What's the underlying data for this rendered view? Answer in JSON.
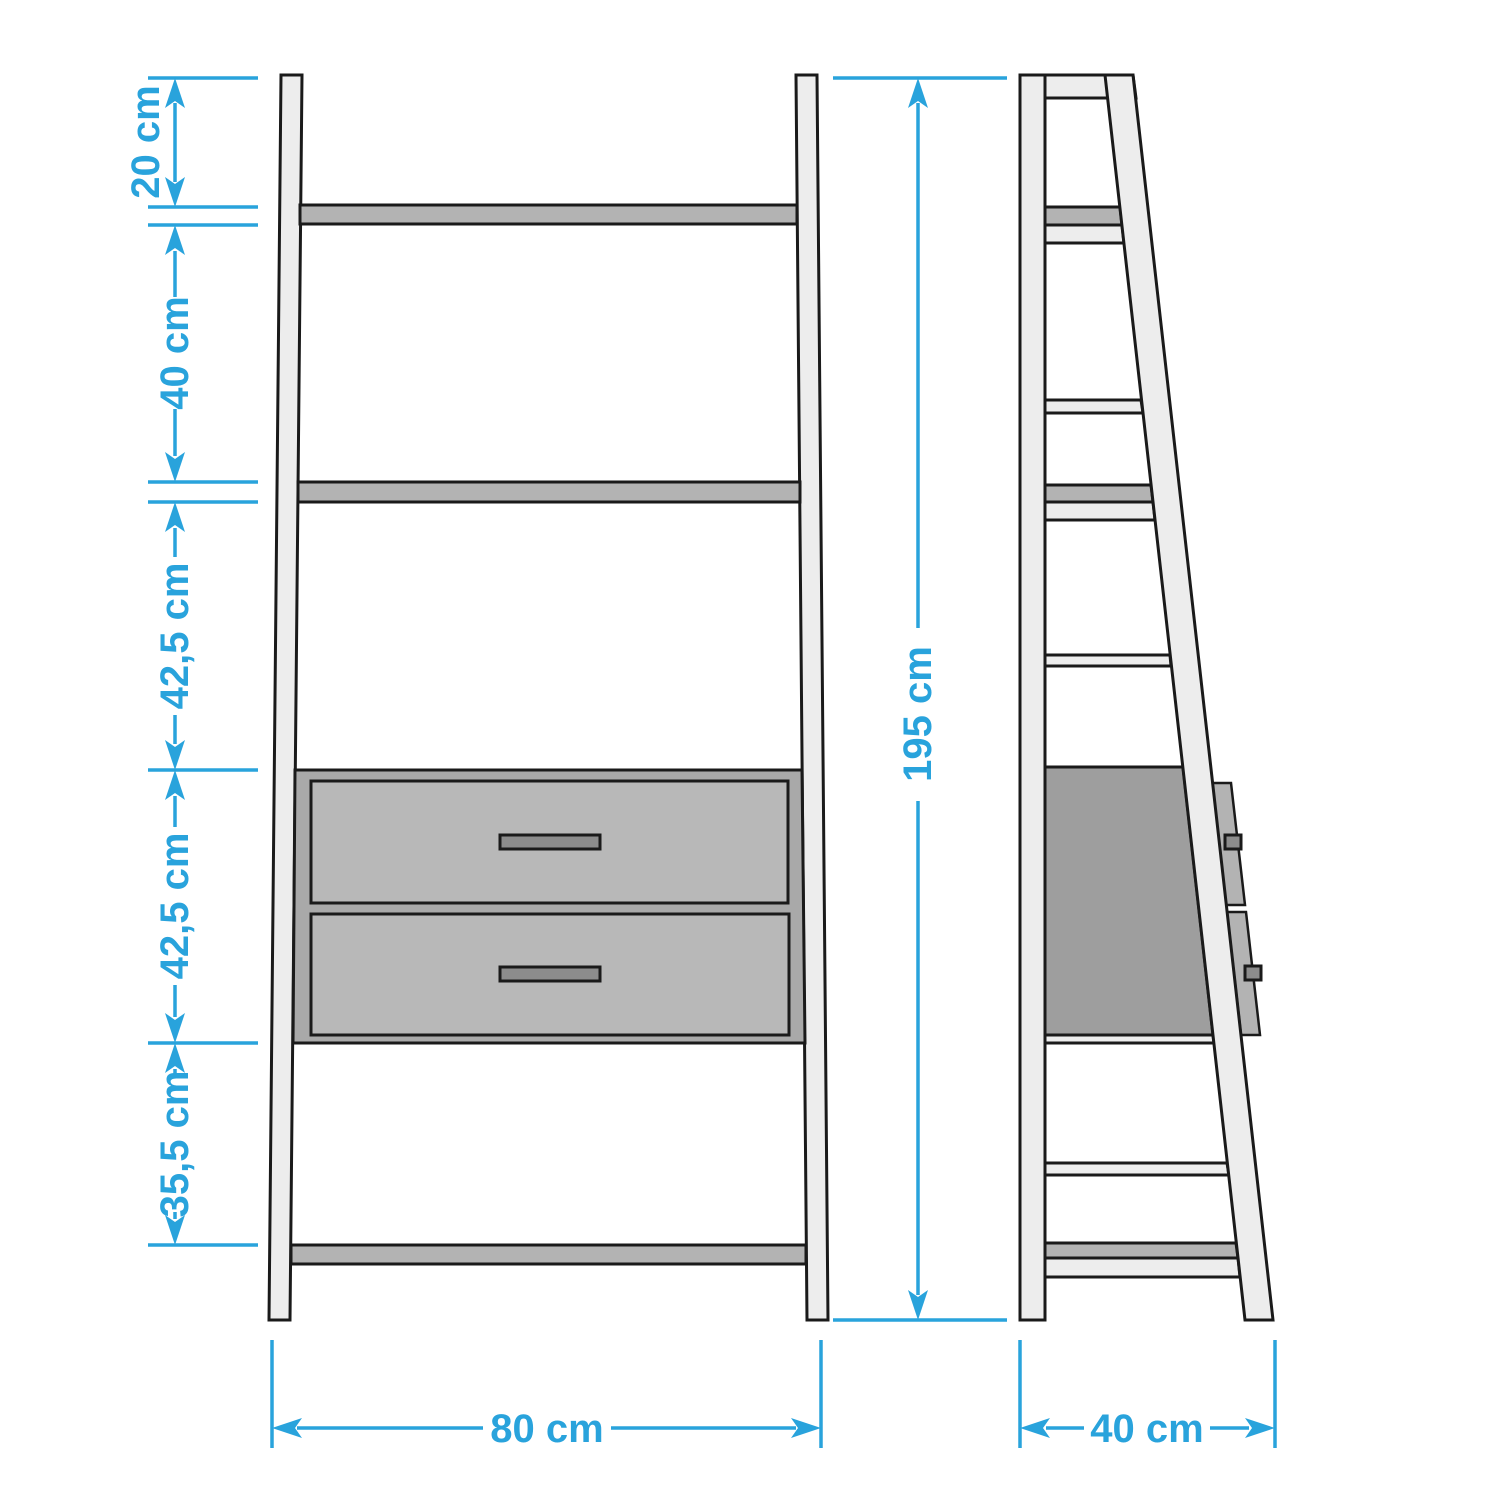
{
  "diagram_type": "furniture-dimension-drawing",
  "unit": "cm",
  "colors": {
    "accent": "#29a3dc",
    "outline": "#1a1a1a",
    "frame_fill": "#ededed",
    "shelf_fill": "#b3b3b3",
    "drawer_box_fill": "#a9a9a9",
    "drawer_front_fill": "#b8b8b8",
    "handle_fill": "#8c8c8c",
    "side_drawer_block_fill": "#9e9e9e"
  },
  "dims": {
    "left_chain": [
      {
        "label": "20 cm"
      },
      {
        "label": "40 cm"
      },
      {
        "label": "42,5 cm"
      },
      {
        "label": "42,5 cm"
      },
      {
        "label": "35,5 cm"
      }
    ],
    "overall_height": {
      "label": "195 cm"
    },
    "front_width": {
      "label": "80 cm"
    },
    "side_depth": {
      "label": "40 cm"
    }
  }
}
